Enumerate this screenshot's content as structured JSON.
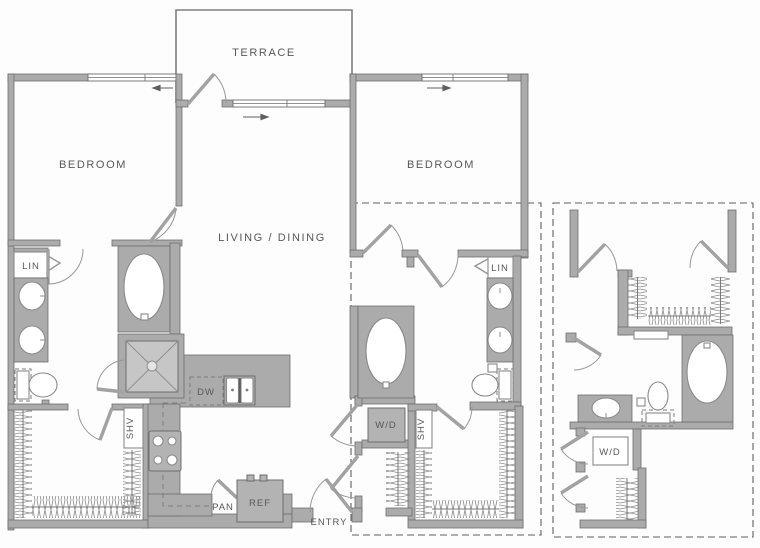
{
  "title": "Two-bedroom apartment floor plan with alternate bathroom detail",
  "palette": {
    "background": "#fdfdfd",
    "wall_fill": "#ababab",
    "wall_stroke": "#6e6e6e",
    "fixture_stroke": "#8a8a8a",
    "label_text": "#585858",
    "dashed_overlay": "#606060"
  },
  "labels": {
    "terrace": "TERRACE",
    "bedroom_left": "BEDROOM",
    "bedroom_right": "BEDROOM",
    "living_dining": "LIVING / DINING",
    "lin_left": "LIN",
    "lin_right": "LIN",
    "dw": "DW",
    "shv_left": "SHV",
    "shv_right": "SHV",
    "wd_main": "W/D",
    "wd_detail": "W/D",
    "pan": "PAN",
    "ref": "REF",
    "entry": "ENTRY"
  }
}
